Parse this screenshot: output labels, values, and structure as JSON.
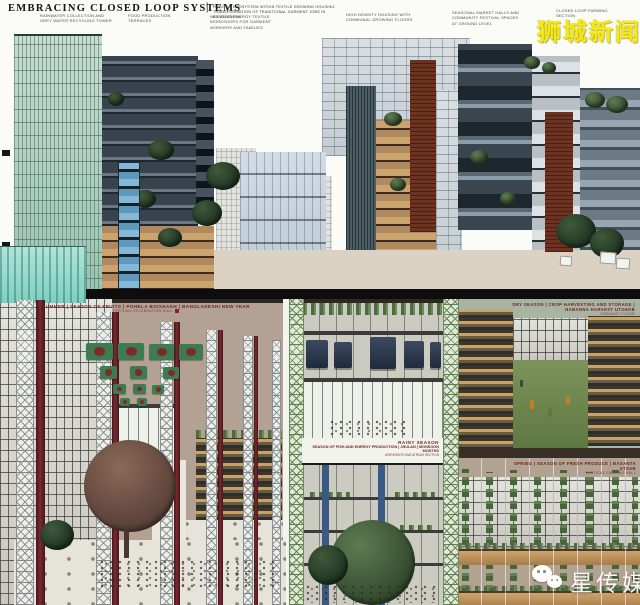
{
  "header": {
    "title": "EMBRACING CLOSED LOOP SYSTEMS",
    "separator": "|",
    "subtitle": "ROBOTIC ECOSYSTEM WITHIN TEXTILE GROWING HOUSING, TRANSFORMATION OF TRADITIONAL GARMENT JOBS IN BANGLADESH",
    "annotations": {
      "a": "RAINWATER COLLECTION AND\nGREY WATER RECYCLING TOWER",
      "b": "FOOD PRODUCTION\nTERRACES",
      "c": "NET ZERO ENERGY TEXTILE\nWORKSHOPS FOR GARMENT\nWORKERS AND FAMILIES",
      "d": "HIGH DENSITY HOUSING WITH\nCOMMUNAL GROWING FLOORS",
      "e": "SEASONAL MARKET HALLS AND\nCOMMUNITY FESTIVAL SPACES\nAT GROUND LEVEL",
      "f": "CLOSED LOOP FARMING\nSECTION"
    }
  },
  "watermarks": {
    "top_right": "狮城新闻",
    "bottom_right": "星传媒"
  },
  "panels": {
    "summer": {
      "caption": "SUMMER | SEASON OF FRUITS | POHELA BOISHAKH | BANGLADESHI NEW YEAR",
      "subcaption": "FESTIVAL CELEBRATION HALL"
    },
    "rainy": {
      "season": "RAINY SEASON",
      "caption": "SEASON OF FISH AND ENERGY PRODUCTION | JHULAN | MONSOON MONTHS",
      "subcaption": "WORKSHOP AND ATRIUM SECTION"
    },
    "dry": {
      "caption": "DRY SEASON | CROP HARVESTING AND STORAGE | NABANNA HARVEST UTSHOB",
      "subcaption": "GRANARY FLOOR"
    },
    "spring": {
      "caption": "SPRING | SEASON OF FRESH PRODUCE | BASANTA UTSAB",
      "subcaption": "VERTICAL FARMING HALL"
    }
  },
  "colors": {
    "flag_green": "#3e7b52",
    "flag_circle": "#7e2a26",
    "maroon_column": "#6b2028",
    "pool_teal": "#7fcfc0",
    "watermark_yellow": "#f3e915",
    "watermark_white": "#ffffff",
    "divider_black": "#0d0d0d"
  }
}
